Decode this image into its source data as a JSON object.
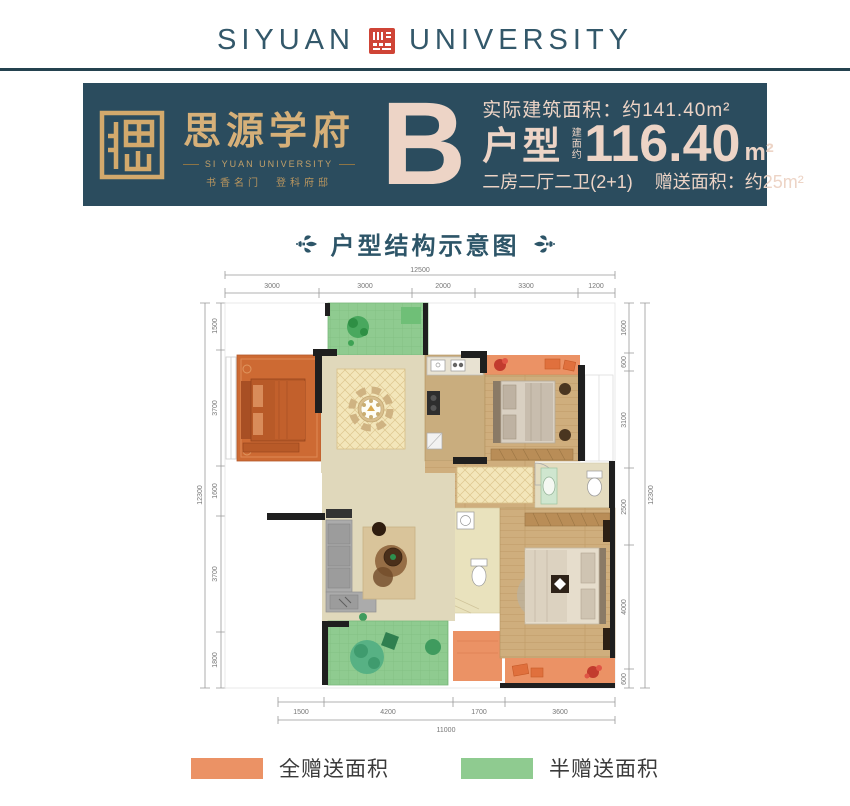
{
  "header": {
    "brand_left": "SIYUAN",
    "brand_right": "UNIVERSITY"
  },
  "banner": {
    "logo_title": "思源学府",
    "logo_subtitle": "SI YUAN UNIVERSITY",
    "logo_slogan": "书香名门　登科府邸",
    "type_letter": "B",
    "actual_area": "实际建筑面积：约141.40m²",
    "type_label": "户型",
    "area_prefix": "建面约",
    "area_value": "116.40",
    "area_unit": "m²",
    "layout_text": "二房二厅二卫(2+1)",
    "gift_area": "赠送面积：约25m²"
  },
  "section_title": "户型结构示意图",
  "plan": {
    "dims": {
      "top": {
        "total": "12500",
        "segments": [
          "3000",
          "3000",
          "2000",
          "3300",
          "1200"
        ]
      },
      "left": {
        "total": "12300",
        "segments": [
          "1500",
          "3700",
          "1600",
          "3700",
          "1800"
        ]
      },
      "right": {
        "total": "12300",
        "segments": [
          "1600",
          "600",
          "3100",
          "2500",
          "4000",
          "600"
        ]
      },
      "bottom": {
        "total": "11000",
        "segments": [
          "1500",
          "4200",
          "1700",
          "3600"
        ]
      }
    },
    "rooms_colors": {
      "full_gift_orange": "#EB9265",
      "half_gift_green": "#8FCB90",
      "bedroom_orange_floor": "#CD6A33",
      "wood_floor": "#CFAE7D",
      "tile_floor": "#E0D8BB"
    }
  },
  "legend": {
    "full": {
      "label": "全赠送面积",
      "color": "#EB9265"
    },
    "half": {
      "label": "半赠送面积",
      "color": "#8FCB90"
    }
  },
  "colors": {
    "banner_bg": "#2B4C5E",
    "banner_text": "#EDD4C6",
    "gold": "#D6B079",
    "brand": "#33586A",
    "title": "#2D5568",
    "seal_red": "#CF4436"
  }
}
